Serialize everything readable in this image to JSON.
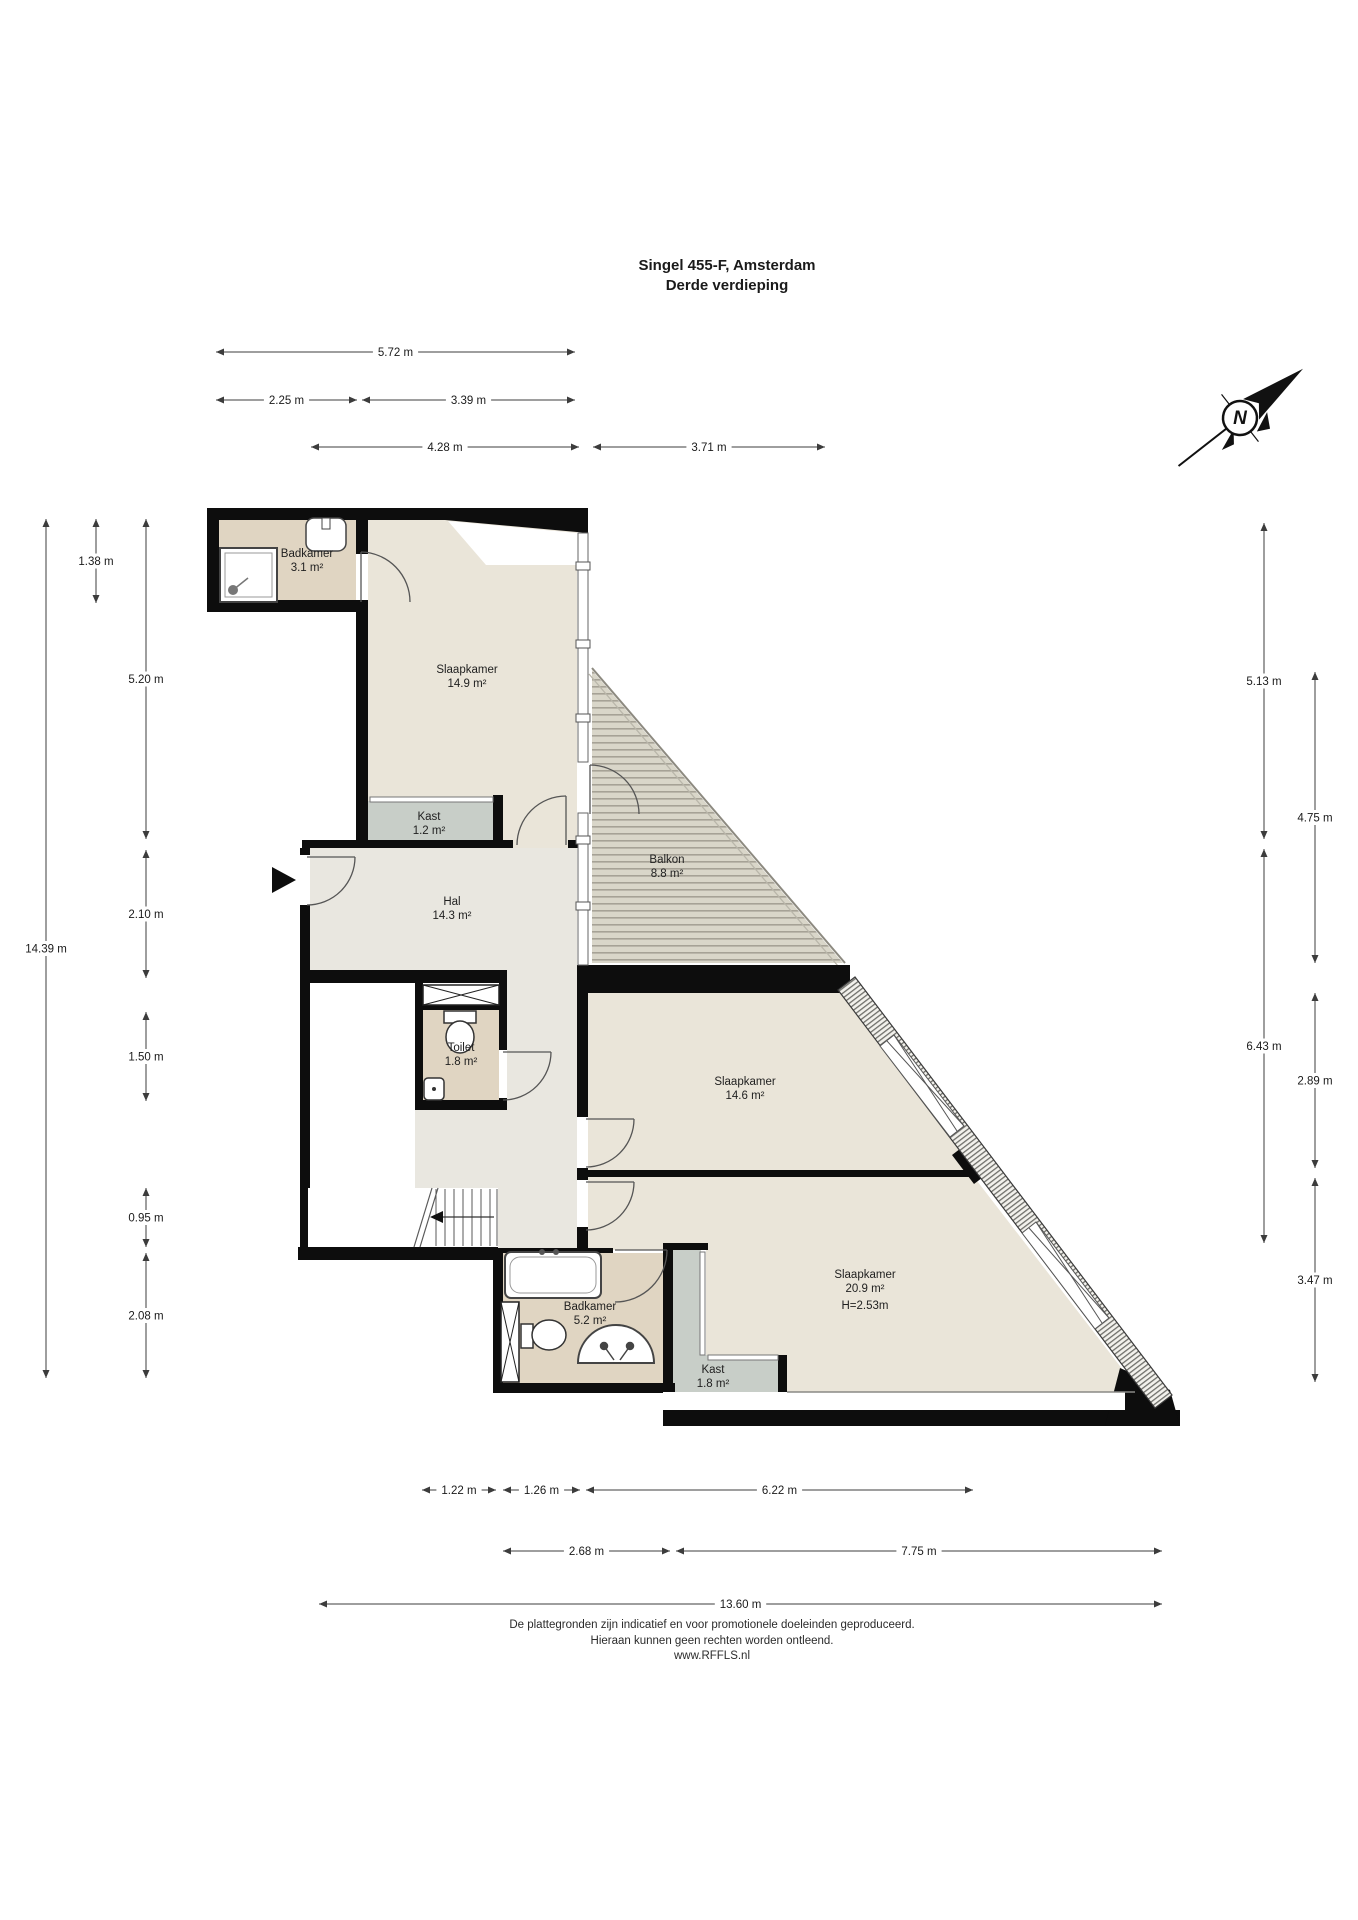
{
  "title": {
    "line1": "Singel 455-F, Amsterdam",
    "line2": "Derde verdieping"
  },
  "compass": {
    "label": "N"
  },
  "rooms": [
    {
      "id": "badkamer-boven",
      "x": 307,
      "y": 557,
      "lines": [
        "Badkamer",
        "3.1 m²"
      ]
    },
    {
      "id": "slaapkamer-1",
      "x": 467,
      "y": 673,
      "lines": [
        "Slaapkamer",
        "14.9 m²"
      ]
    },
    {
      "id": "kast-1",
      "x": 429,
      "y": 820,
      "lines": [
        "Kast",
        "1.2 m²"
      ]
    },
    {
      "id": "hal",
      "x": 452,
      "y": 905,
      "lines": [
        "Hal",
        "14.3 m²"
      ]
    },
    {
      "id": "balkon",
      "x": 667,
      "y": 863,
      "lines": [
        "Balkon",
        "8.8 m²"
      ]
    },
    {
      "id": "toilet",
      "x": 461,
      "y": 1051,
      "lines": [
        "Toilet",
        "1.8 m²"
      ]
    },
    {
      "id": "slaapkamer-2",
      "x": 745,
      "y": 1085,
      "lines": [
        "Slaapkamer",
        "14.6 m²"
      ]
    },
    {
      "id": "slaapkamer-3",
      "x": 865,
      "y": 1278,
      "lines": [
        "Slaapkamer",
        "20.9 m²",
        "H=2.53m"
      ]
    },
    {
      "id": "badkamer-onder",
      "x": 590,
      "y": 1310,
      "lines": [
        "Badkamer",
        "5.2 m²"
      ]
    },
    {
      "id": "kast-2",
      "x": 713,
      "y": 1373,
      "lines": [
        "Kast",
        "1.8 m²"
      ]
    }
  ],
  "dimensions": [
    {
      "orient": "h",
      "a": 216,
      "b": 575,
      "pos": 352,
      "label": "5.72 m"
    },
    {
      "orient": "h",
      "a": 216,
      "b": 357,
      "pos": 400,
      "label": "2.25 m"
    },
    {
      "orient": "h",
      "a": 362,
      "b": 575,
      "pos": 400,
      "label": "3.39 m"
    },
    {
      "orient": "h",
      "a": 311,
      "b": 579,
      "pos": 447,
      "label": "4.28 m"
    },
    {
      "orient": "h",
      "a": 593,
      "b": 825,
      "pos": 447,
      "label": "3.71 m"
    },
    {
      "orient": "h",
      "a": 422,
      "b": 496,
      "pos": 1490,
      "label": "1.22 m"
    },
    {
      "orient": "h",
      "a": 503,
      "b": 580,
      "pos": 1490,
      "label": "1.26 m"
    },
    {
      "orient": "h",
      "a": 586,
      "b": 973,
      "pos": 1490,
      "label": "6.22 m"
    },
    {
      "orient": "h",
      "a": 503,
      "b": 670,
      "pos": 1551,
      "label": "2.68 m"
    },
    {
      "orient": "h",
      "a": 676,
      "b": 1162,
      "pos": 1551,
      "label": "7.75 m"
    },
    {
      "orient": "h",
      "a": 319,
      "b": 1162,
      "pos": 1604,
      "label": "13.60 m"
    },
    {
      "orient": "v",
      "a": 519,
      "b": 1378,
      "pos": 46,
      "label": "14.39 m"
    },
    {
      "orient": "v",
      "a": 519,
      "b": 603,
      "pos": 96,
      "label": "1.38 m"
    },
    {
      "orient": "v",
      "a": 519,
      "b": 839,
      "pos": 146,
      "label": "5.20 m"
    },
    {
      "orient": "v",
      "a": 850,
      "b": 978,
      "pos": 146,
      "label": "2.10 m"
    },
    {
      "orient": "v",
      "a": 1012,
      "b": 1101,
      "pos": 146,
      "label": "1.50 m"
    },
    {
      "orient": "v",
      "a": 1188,
      "b": 1247,
      "pos": 146,
      "label": "0.95 m"
    },
    {
      "orient": "v",
      "a": 1253,
      "b": 1378,
      "pos": 146,
      "label": "2.08 m"
    },
    {
      "orient": "v",
      "a": 523,
      "b": 839,
      "pos": 1264,
      "label": "5.13 m"
    },
    {
      "orient": "v",
      "a": 849,
      "b": 1243,
      "pos": 1264,
      "label": "6.43 m"
    },
    {
      "orient": "v",
      "a": 672,
      "b": 963,
      "pos": 1315,
      "label": "4.75 m"
    },
    {
      "orient": "v",
      "a": 993,
      "b": 1168,
      "pos": 1315,
      "label": "2.89 m"
    },
    {
      "orient": "v",
      "a": 1178,
      "b": 1382,
      "pos": 1315,
      "label": "3.47 m"
    }
  ],
  "footer": {
    "line1": "De plattegronden zijn indicatief en voor promotionele doeleinden geproduceerd.",
    "line2": "Hieraan kunnen geen rechten worden ontleend.",
    "line3": "www.RFFLS.nl"
  },
  "colors": {
    "wall": "#0d0d0d",
    "bedroom": "#EAE5D9",
    "hall": "#E9E7E0",
    "bath": "#E0D5C2",
    "closet": "#C8CEC8",
    "balcony": "#D9D6C9",
    "balcony_stripe": "#A6A296",
    "dimension": "#3c3c3c",
    "label_text": "#1f1f1f"
  }
}
